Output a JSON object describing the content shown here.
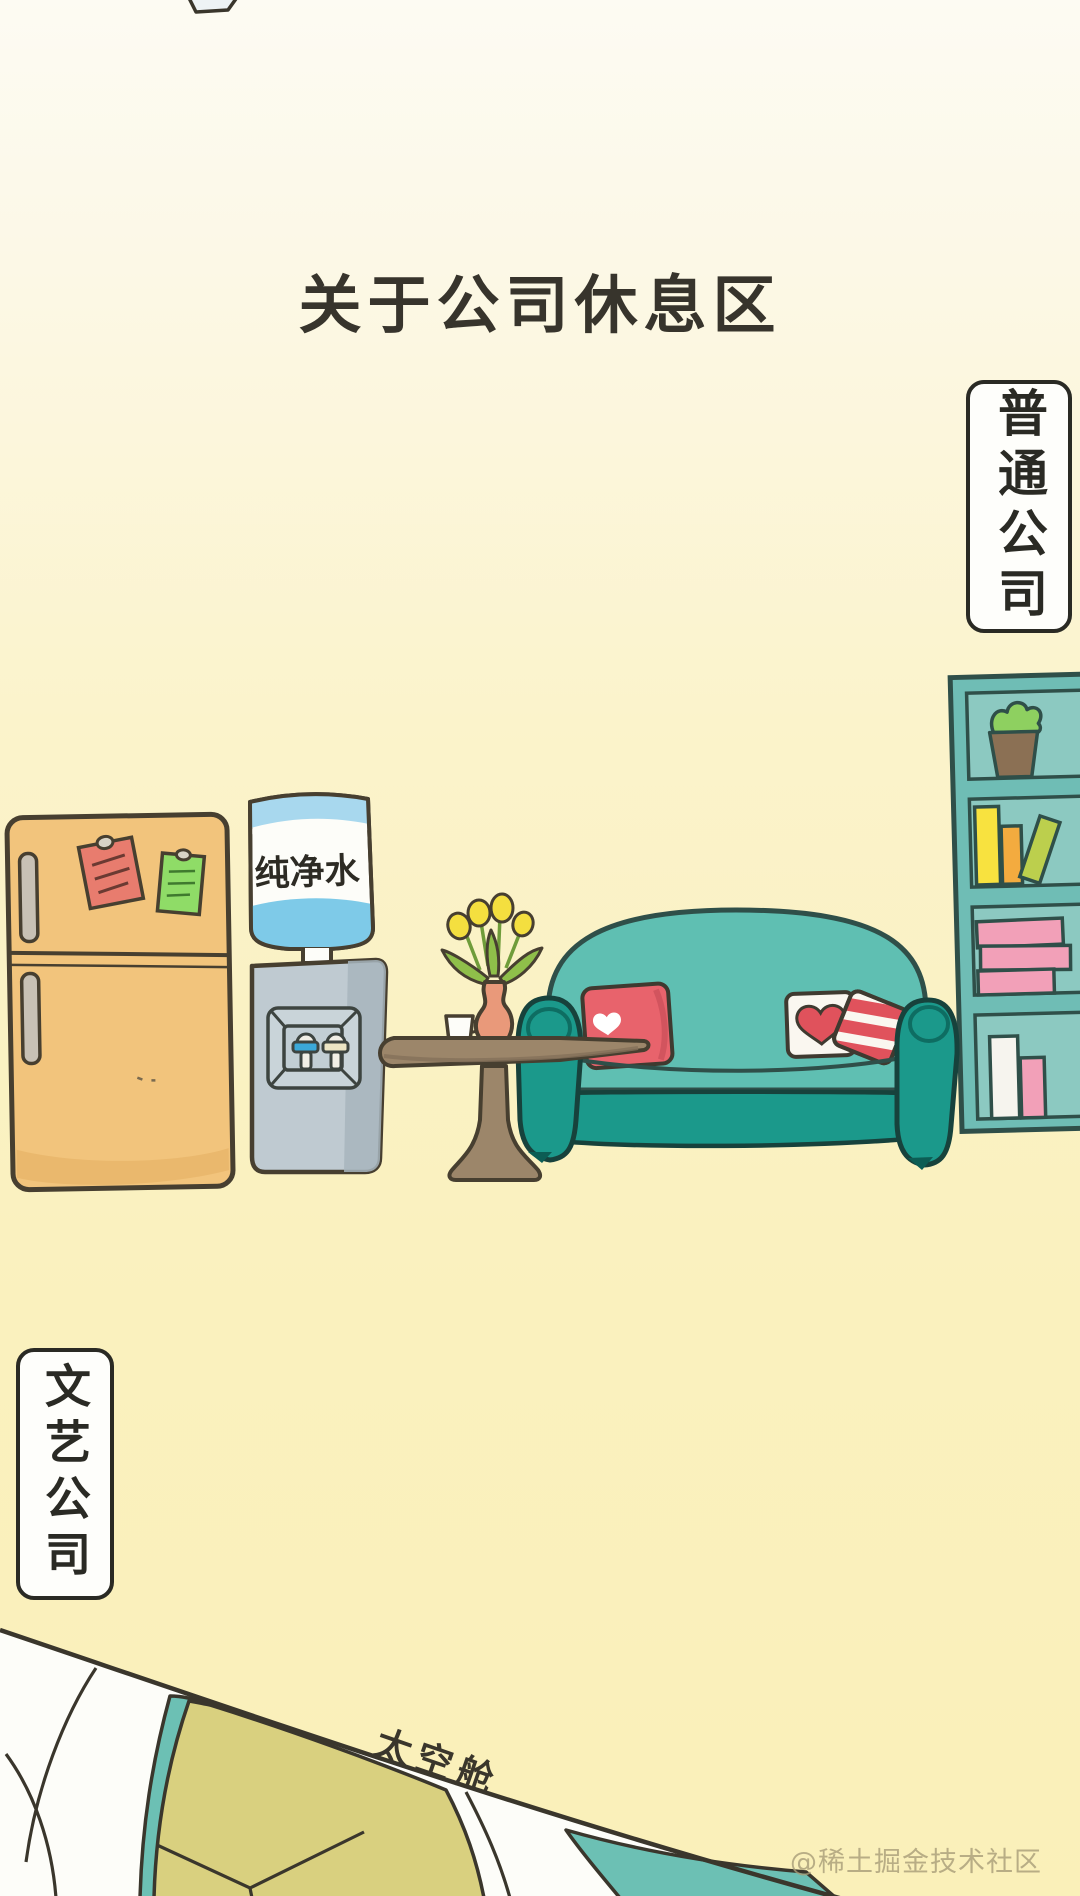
{
  "title": "关于公司休息区",
  "labels": {
    "ordinary_company": "普通公司",
    "artsy_company": "文艺公司",
    "water_bottle": "纯净水",
    "space_capsule": "太空舱"
  },
  "watermark": "@稀土掘金技术社区",
  "scene_objects": [
    "refrigerator",
    "sticky-note-red",
    "sticky-note-green",
    "water-dispenser",
    "water-bottle",
    "coffee-table",
    "cup",
    "vase-with-flowers",
    "sofa",
    "pillow-red-heart",
    "pillow-white-heart",
    "pillow-striped",
    "bookshelf",
    "potted-plant",
    "books",
    "space-capsule"
  ],
  "colors": {
    "background_top": "#fdfbf3",
    "background_bottom": "#faf0b9",
    "outline": "#3e392e",
    "title_text": "#37342c",
    "fridge_body": "#f2c47c",
    "fridge_shade": "#e4af61",
    "fridge_handle": "#c8c1b5",
    "note_red": "#e87c6e",
    "note_green": "#8fdc67",
    "bottle_white": "#fdfdf9",
    "bottle_blue": "#a8d8ee",
    "water_blue": "#7ecae8",
    "dispenser_body": "#bfcad1",
    "dispenser_shade": "#a7b5bd",
    "panel_face": "#c9d4d9",
    "tap_blue": "#3ba8d8",
    "tap_cream": "#ece5c4",
    "table_wood": "#9c866a",
    "vase": "#e9997a",
    "flower_yellow": "#f4df3f",
    "leaf_green": "#8fbf4a",
    "stem_green": "#6f9c3a",
    "sofa_light": "#5fbfb2",
    "sofa_dark": "#1b998b",
    "sofa_detail": "#0e6d62",
    "pillow_red": "#e8636c",
    "heart_red": "#e0525c",
    "pillow_white": "#faf7f0",
    "bookshelf_frame": "#6fbdb5",
    "bookshelf_inner": "#8cc9c1",
    "book_yellow": "#f8e23f",
    "book_orange": "#f3ab3f",
    "book_green": "#bccf4d",
    "book_pink": "#f2a0b8",
    "book_white": "#f6f4ee",
    "plant_green": "#8ed060",
    "pot_brown": "#8b7054",
    "capsule_white": "#fdfdf9",
    "capsule_teal": "#6cc0b4",
    "capsule_olive": "#d9d07f"
  }
}
